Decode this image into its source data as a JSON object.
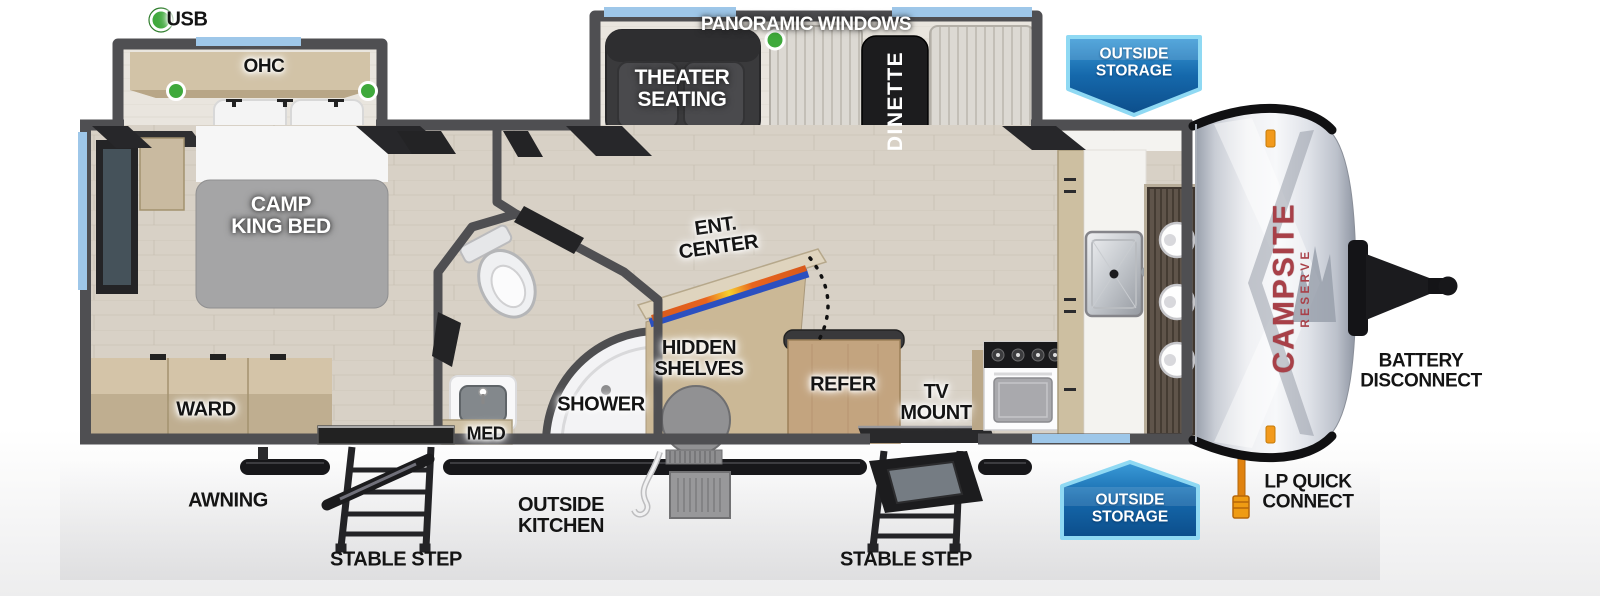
{
  "title": "Campsite Reserve travel trailer floorplan",
  "colors": {
    "wall_gray": "#4f4f52",
    "floor_wood": "#d8d1c6",
    "window_blue": "#9ec7e9",
    "accent_green": "#3fa93c",
    "banner_blue": "#1568ab",
    "banner_border": "#8fd9f3",
    "brand_red": "#a84048",
    "lp_orange": "#e0820f"
  },
  "brand": {
    "name": "CAMPSITE",
    "series": "RESERVE"
  },
  "labels": {
    "usb": "USB",
    "panoramic_windows": "PANORAMIC WINDOWS",
    "ohc": "OHC",
    "outside_storage_top": "OUTSIDE\nSTORAGE",
    "theater_seating": "THEATER\nSEATING",
    "dinette": "DINETTE",
    "camp_king_bed": "CAMP\nKING BED",
    "ent_center": "ENT.\nCENTER",
    "hidden_shelves": "HIDDEN\nSHELVES",
    "refer": "REFER",
    "tv_mount": "TV\nMOUNT",
    "shower": "SHOWER",
    "med": "MED",
    "ward": "WARD",
    "awning": "AWNING",
    "outside_kitchen": "OUTSIDE\nKITCHEN",
    "stable_step_left": "STABLE STEP",
    "stable_step_right": "STABLE STEP",
    "outside_storage_bottom": "OUTSIDE\nSTORAGE",
    "lp_quick_connect": "LP QUICK\nCONNECT",
    "battery_disconnect": "BATTERY\nDISCONNECT"
  }
}
